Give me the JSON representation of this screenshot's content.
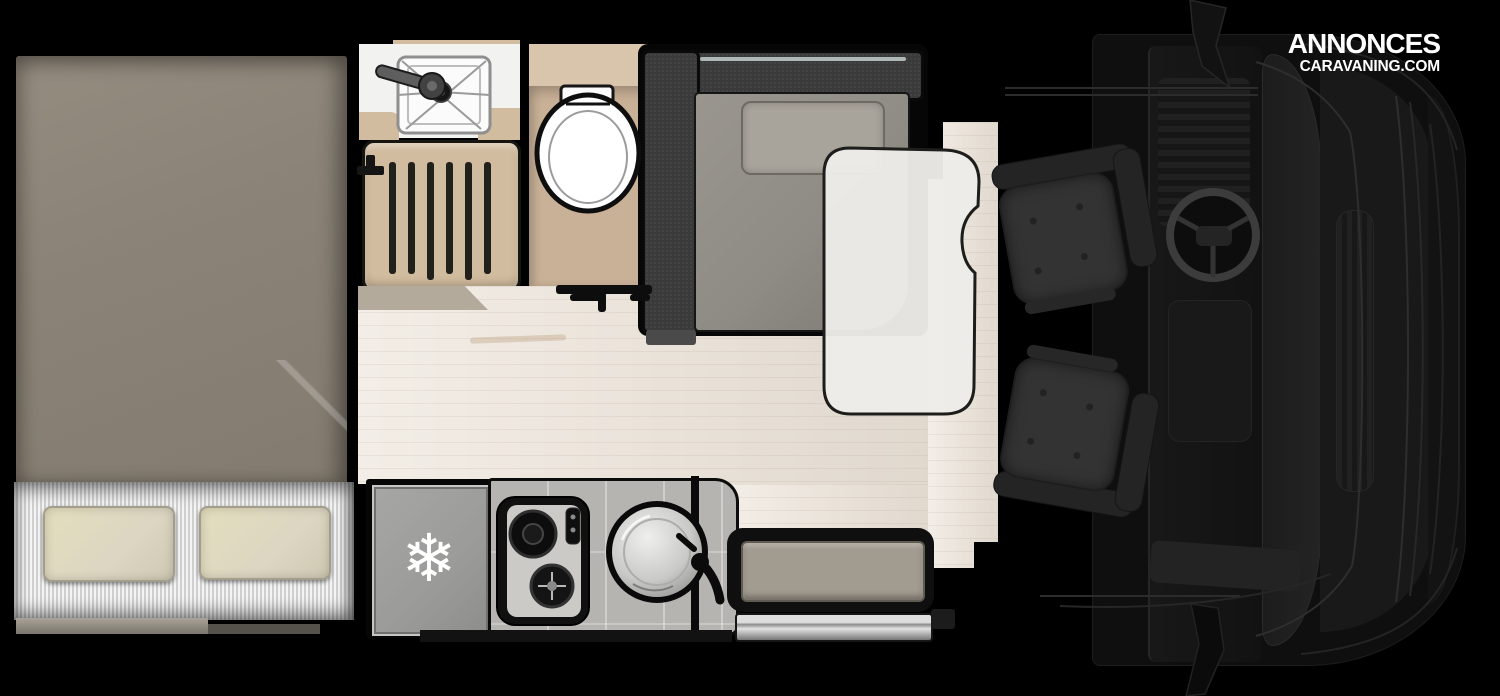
{
  "watermark": {
    "line1": "ANNONCES",
    "line2": "CARAVANING.COM"
  },
  "icons": {
    "snowflake": "❄"
  },
  "colors": {
    "bg": "#000000",
    "duvet": "#8b8377",
    "sheet_light": "#f4f4f4",
    "sheet_dark": "#cfcfcf",
    "pillow": "#dcd6c2",
    "tan": "#d2bc9f",
    "toilet_floor": "#c9b197",
    "wood": "#ece4d9",
    "bench": "#3a3a3a",
    "cushion": "#8f8c85",
    "back_pillow": "#a8a39b",
    "table": "#edece9",
    "fridge": "#9b9b99",
    "counter": "#b6b4b0",
    "entry_cushion": "#a29b90",
    "seat": "#333333",
    "watermark_text": "#ffffff"
  }
}
